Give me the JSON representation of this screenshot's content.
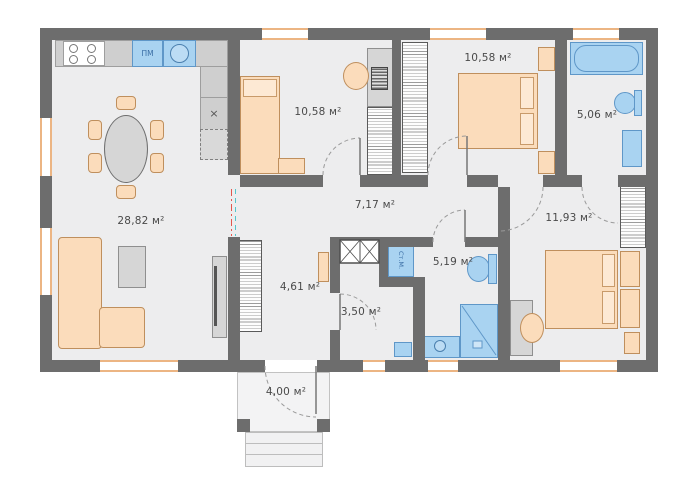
{
  "plan": {
    "type": "house-floor-plan",
    "rooms": [
      {
        "name": "living-kitchen",
        "area_label": "28,82 м²"
      },
      {
        "name": "bedroom-middle",
        "area_label": "10,58 м²"
      },
      {
        "name": "bedroom-right",
        "area_label": "10,58 м²"
      },
      {
        "name": "bathroom-top",
        "area_label": "5,06 м²"
      },
      {
        "name": "hallway",
        "area_label": "7,17 м²"
      },
      {
        "name": "bedroom-master",
        "area_label": "11,93 м²"
      },
      {
        "name": "entry-hall",
        "area_label": "4,61 м²"
      },
      {
        "name": "wc",
        "area_label": "3,50 м²"
      },
      {
        "name": "bathroom-shower",
        "area_label": "5,19 м²"
      },
      {
        "name": "porch",
        "area_label": "4,00 м²"
      }
    ],
    "appliances": {
      "dishwasher_label": "ПМ",
      "washing_machine_label": "Ст.М.",
      "hob_symbol": "×"
    },
    "fixtures": [
      "stove",
      "kitchen-sink",
      "dishwasher",
      "fridge",
      "dining-table",
      "sofa",
      "coffee-table",
      "tv-stand",
      "wardrobes",
      "single-bed",
      "double-bed",
      "desks",
      "bathtub",
      "toilets",
      "shower",
      "vanities",
      "washing-machine",
      "entry-steps"
    ],
    "colors": {
      "wall": "#6d6d6d",
      "floor": "#ededee",
      "furniture_wood": "#fbdcbb",
      "furniture_gray": "#d6d6d6",
      "plumbing": "#a9d3f1",
      "window_frame": "#ecb583",
      "opening_marker_red": "#e2574d",
      "opening_marker_cyan": "#53c6cc"
    }
  }
}
